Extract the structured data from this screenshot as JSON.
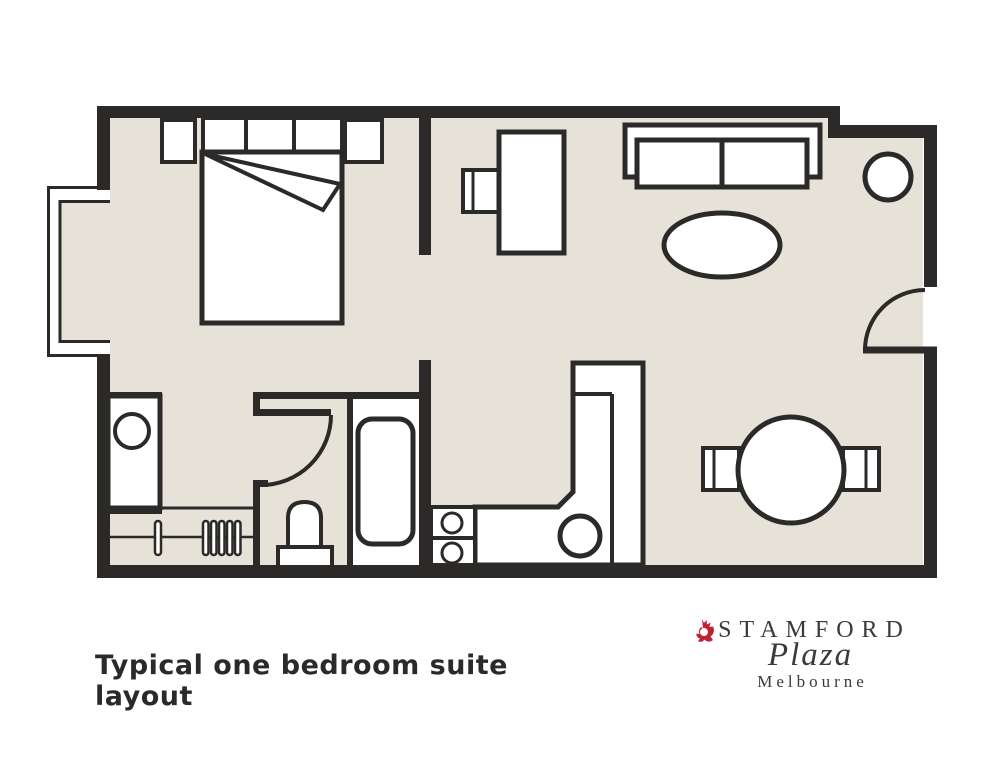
{
  "colors": {
    "wall": "#2b2a28",
    "floor": "#e6e2d7",
    "logo_red": "#c22033",
    "logo_text": "#3d3935"
  },
  "caption": {
    "text": "Typical one bedroom suite layout"
  },
  "logo": {
    "name": "STAMFORD",
    "script": "Plaza",
    "city": "Melbourne",
    "crest": "stamford-crest-icon"
  },
  "floorplan": {
    "type": "hotel-suite-floor-plan",
    "rooms": [
      "bedroom",
      "living-dining-area",
      "kitchenette",
      "bathroom",
      "wardrobe-nook",
      "entry"
    ],
    "furniture": [
      "double-bed",
      "bed-headboard",
      "nightstand-left",
      "nightstand-right",
      "turned-down-sheet",
      "bay-window",
      "desk",
      "desk-chair",
      "sofa",
      "coffee-table",
      "round-side-table",
      "entry-door",
      "dining-table",
      "dining-chair-left",
      "dining-chair-right",
      "kitchen-counter",
      "kitchen-sink",
      "two-burner-cooktop",
      "bathroom-door",
      "bathtub",
      "vanity-basin",
      "toilet",
      "clothes-rail",
      "coat-hangers"
    ]
  }
}
